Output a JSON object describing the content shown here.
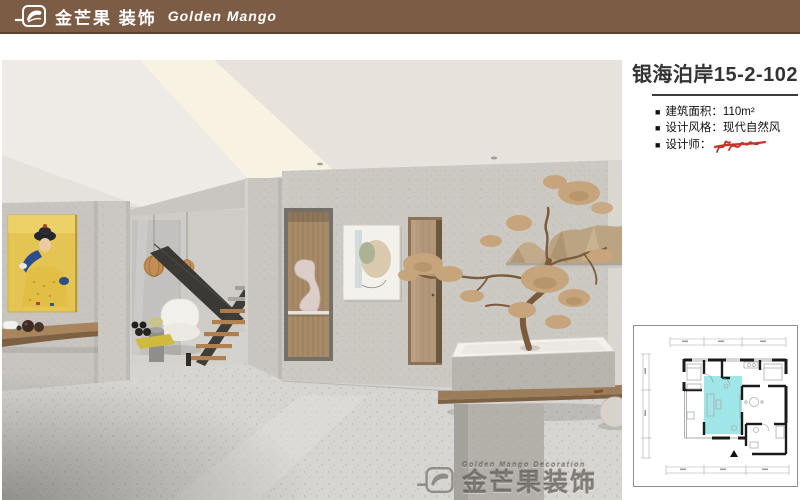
{
  "header": {
    "brand_cn": "金芒果 装饰",
    "brand_en": "Golden Mango"
  },
  "project": {
    "title": "银海泊岸15-2-102",
    "bullet": "■",
    "details": [
      "建筑面积：110m²",
      "设计风格：现代自然风",
      "设计师："
    ]
  },
  "watermark": {
    "small_text": "Golden Mango Decoration",
    "large_text": "金芒果装饰"
  },
  "floor_plan": {
    "highlight_color": "#8FE1E3"
  },
  "colors": {
    "header_brown": "#7D5C46",
    "signature_red": "#C43329",
    "divider_dark": "#3C3C3C",
    "plan_highlight": "#8FE1E3"
  }
}
